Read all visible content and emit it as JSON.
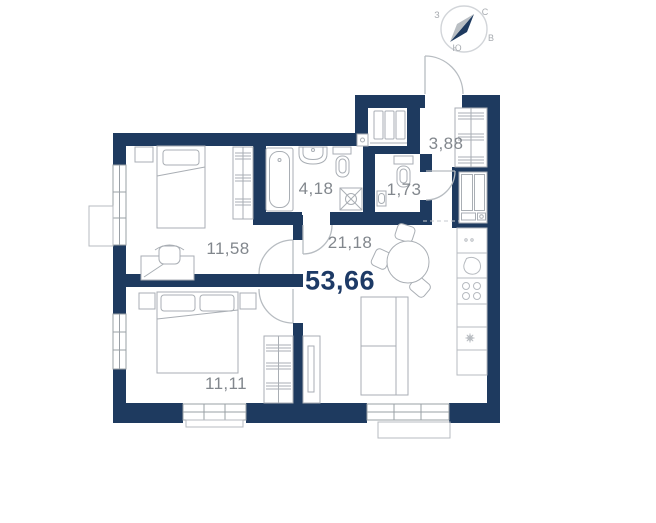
{
  "plan": {
    "title": "apartment floor plan",
    "total_area": "53,66",
    "rooms": [
      {
        "name": "bedroom-1",
        "area": "11,58"
      },
      {
        "name": "bathroom",
        "area": "4,18"
      },
      {
        "name": "wc",
        "area": "1,73"
      },
      {
        "name": "hallway",
        "area": "3,88"
      },
      {
        "name": "kitchen-living",
        "area": "21,18"
      },
      {
        "name": "bedroom-2",
        "area": "11,11"
      }
    ],
    "compass": {
      "north": "С",
      "east": "В",
      "south": "Ю",
      "west": "З"
    },
    "colors": {
      "wall": "#1e3a5f",
      "furniture_line": "#a9aeb4",
      "kitchen_line": "#b7bbc0",
      "window_line": "#9aa0a6",
      "door_line": "#b7bcc1",
      "label_text": "#82878d",
      "total_text": "#1d3a66"
    }
  }
}
